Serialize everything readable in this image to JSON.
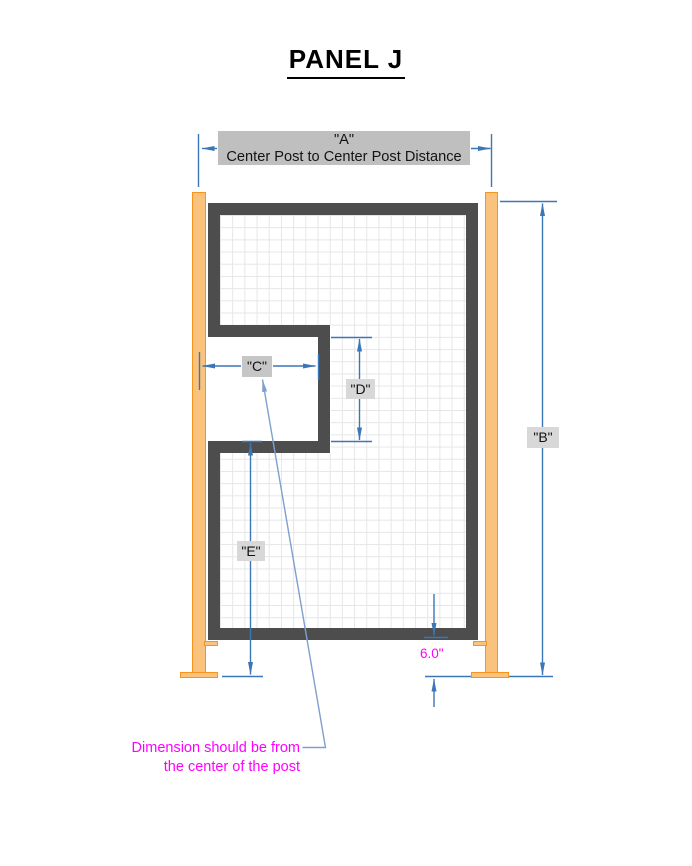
{
  "title": "PANEL J",
  "dim_a": {
    "label": "\"A\"",
    "description": "Center Post to Center Post Distance"
  },
  "dim_b": {
    "label": "\"B\""
  },
  "dim_c": {
    "label": "\"C\""
  },
  "dim_d": {
    "label": "\"D\""
  },
  "dim_e": {
    "label": "\"E\""
  },
  "dim_post_offset": {
    "value": "6.0\""
  },
  "note": {
    "line1": "Dimension should be from",
    "line2": "the center of the post"
  },
  "colors": {
    "dimension_blue": "#3B76B7",
    "leader_blue": "#7E9FD0",
    "note_magenta": "#FF00FF",
    "post_orange_fill": "#FAC37D",
    "post_orange_stroke": "#F7941D",
    "frame_dark_gray": "#4D4D4D",
    "mesh_grid_gray": "#E6E6E6",
    "header_box_gray": "#BFBFBF",
    "label_box_gray": "#D8D8D8"
  }
}
